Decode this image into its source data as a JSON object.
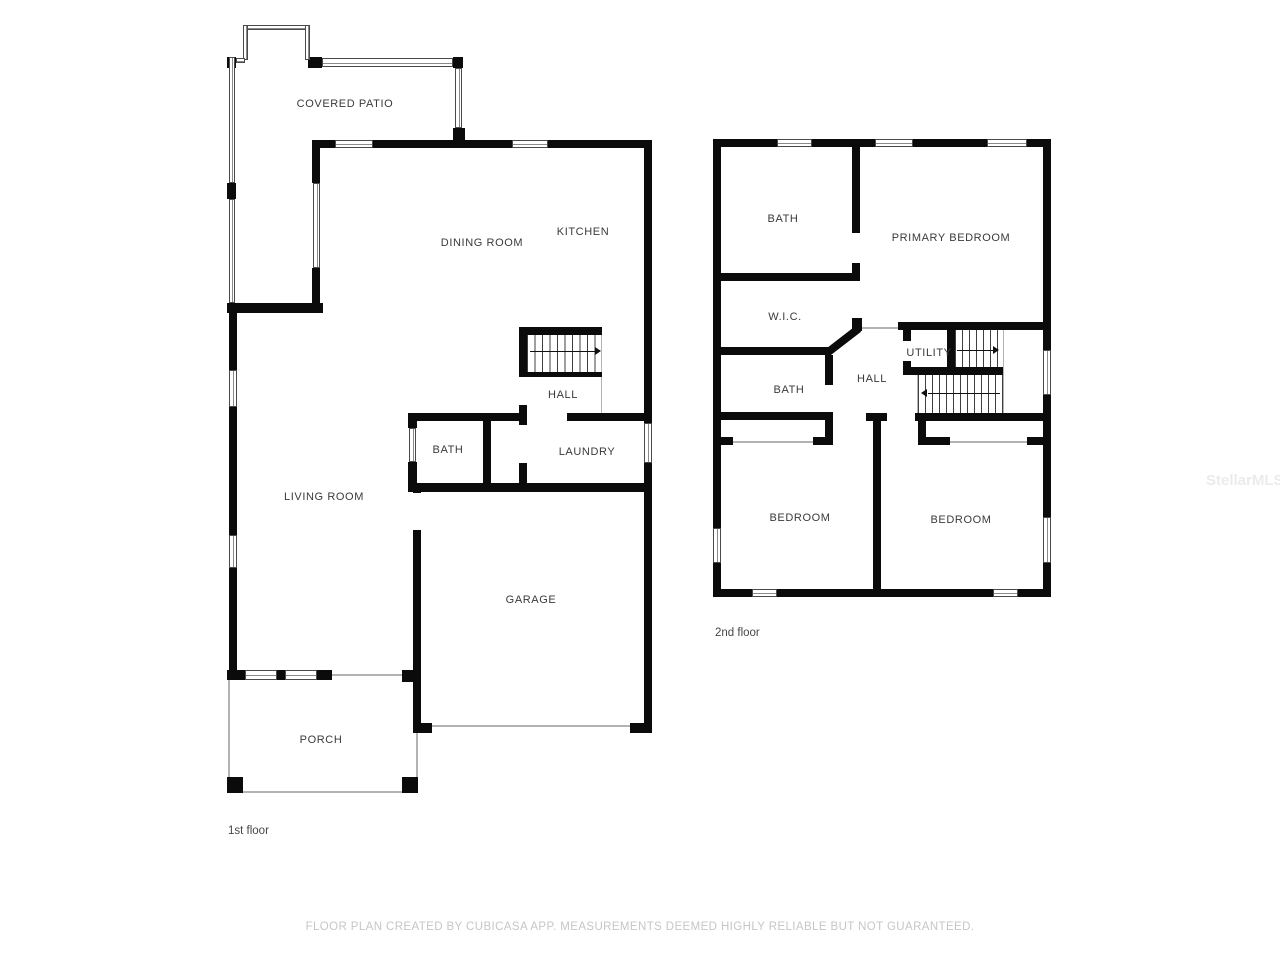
{
  "floors": [
    {
      "name": "1st floor",
      "rooms": [
        {
          "label": "COVERED PATIO"
        },
        {
          "label": "DINING ROOM"
        },
        {
          "label": "KITCHEN"
        },
        {
          "label": "HALL"
        },
        {
          "label": "BATH"
        },
        {
          "label": "LAUNDRY"
        },
        {
          "label": "LIVING ROOM"
        },
        {
          "label": "GARAGE"
        },
        {
          "label": "PORCH"
        }
      ]
    },
    {
      "name": "2nd floor",
      "rooms": [
        {
          "label": "BATH"
        },
        {
          "label": "PRIMARY BEDROOM"
        },
        {
          "label": "W.I.C."
        },
        {
          "label": "UTILITY"
        },
        {
          "label": "HALL"
        },
        {
          "label": "BATH"
        },
        {
          "label": "BEDROOM"
        },
        {
          "label": "BEDROOM"
        }
      ]
    }
  ],
  "footer": {
    "disclaimer": "FLOOR PLAN CREATED BY CUBICASA APP. MEASUREMENTS DEEMED HIGHLY RELIABLE BUT NOT GUARANTEED."
  },
  "watermark": "StellarMLS",
  "colors": {
    "wall": "#0b0b0b",
    "label": "#3a3a3a",
    "disclaimer": "#c6c6c6",
    "watermark": "#ebebeb"
  }
}
